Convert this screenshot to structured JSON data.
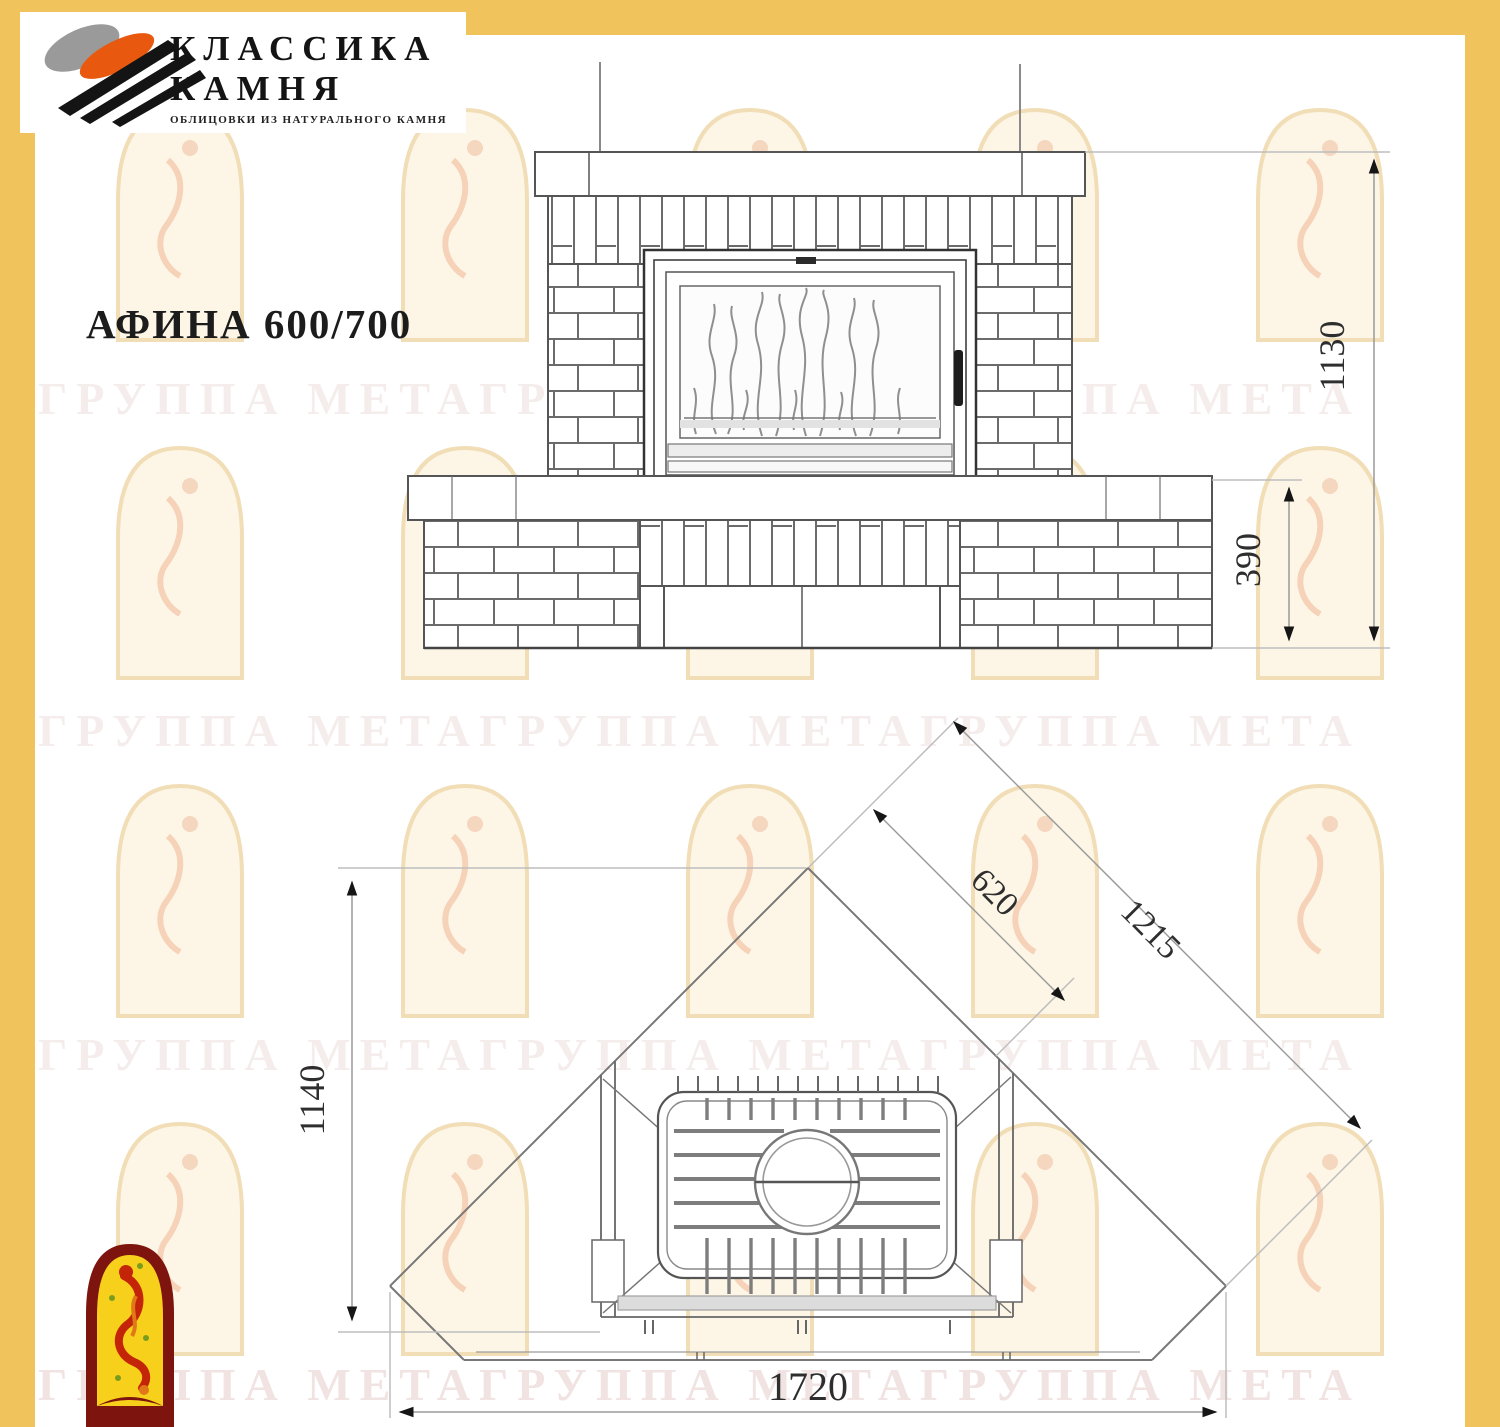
{
  "brand": {
    "name_line1": "КЛАССИКА",
    "name_line2": "КАМНЯ",
    "tagline": "ОБЛИЦОВКИ ИЗ НАТУРАЛЬНОГО КАМНЯ"
  },
  "title": "АФИНА 600/700",
  "watermark_text": "ГРУППА МЕТАГРУППА МЕТАГРУППА МЕТА",
  "dimensions": {
    "total_height": "1130",
    "plinth_height": "390",
    "plan_depth": "620",
    "wall_length": "1215",
    "plan_height": "1140",
    "front_width": "1720"
  },
  "colors": {
    "frame_yellow": "#f0c35c",
    "logo_orange": "#e8590f",
    "logo_gray": "#9a9a9a",
    "logo_black": "#141414",
    "mark_border_red": "#7d140d",
    "mark_fill_yellow": "#f7d01c",
    "mark_figure_red": "#c42408",
    "drawing_line": "#555555",
    "dim_line": "#9a9a9a",
    "watermark_pink": "#c18c86"
  }
}
